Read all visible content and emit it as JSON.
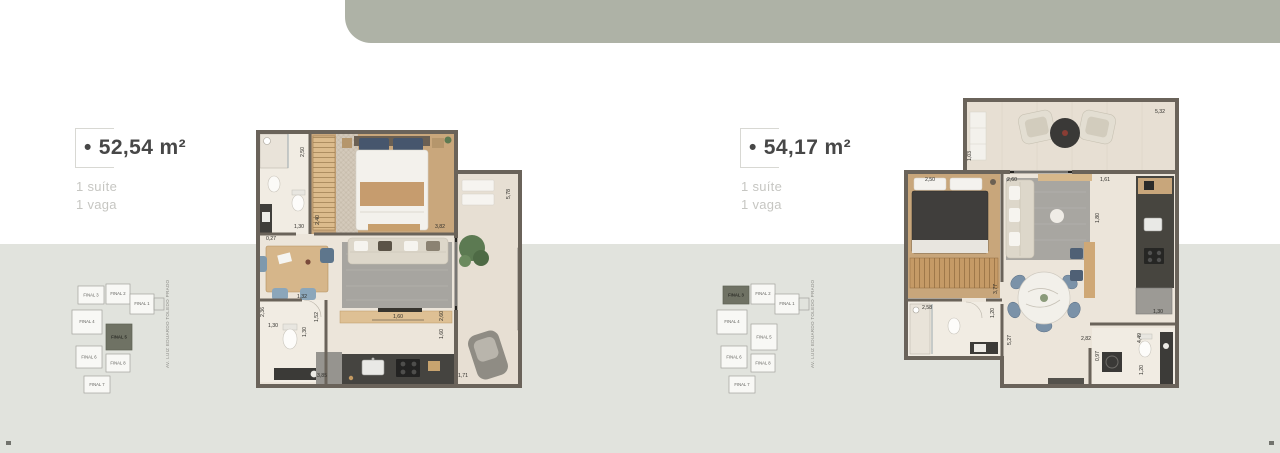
{
  "page": {
    "header_bar_color": "#aeb2a6",
    "background_bottom": "#e1e3dd",
    "keyplan_highlight_color": "#6f7264",
    "wall_color": "#6a635a"
  },
  "units": [
    {
      "name": "FINAL 5",
      "bullet": "•",
      "area": "52,54 m²",
      "features": [
        "1 suíte",
        "1 vaga"
      ],
      "keyplan": {
        "street": "AV.  LUIZ EDUARDO TOLEDO PRADO",
        "highlighted": "FINAL 5",
        "labels": [
          "FINAL 3",
          "FINAL 2",
          "FINAL 1",
          "FINAL 4",
          "FINAL 5",
          "FINAL 6",
          "FINAL 8",
          "FINAL 7"
        ]
      },
      "dimensions": [
        "2,50",
        "1,30",
        "2,40",
        "3,82",
        "5,78",
        "0,27",
        "2,36",
        "1,32",
        "1,30",
        "1,30",
        "1,52",
        "1,60",
        "2,60",
        "1,60",
        "3,85",
        "1,71"
      ]
    },
    {
      "name": "FINAL 3",
      "bullet": "•",
      "area": "54,17 m²",
      "features": [
        "1 suíte",
        "1 vaga"
      ],
      "keyplan": {
        "street": "AV.  LUIZ EDUARDO TOLEDO PRADO",
        "highlighted": "FINAL 3",
        "labels": [
          "FINAL 3",
          "FINAL 2",
          "FINAL 1",
          "FINAL 4",
          "FINAL 5",
          "FINAL 6",
          "FINAL 8",
          "FINAL 7"
        ]
      },
      "dimensions": [
        "5,32",
        "1,03",
        "2,50",
        "2,60",
        "1,61",
        "1,80",
        "3,77",
        "1,20",
        "2,58",
        "5,27",
        "2,82",
        "0,97",
        "4,49",
        "1,30",
        "1,20"
      ]
    }
  ]
}
